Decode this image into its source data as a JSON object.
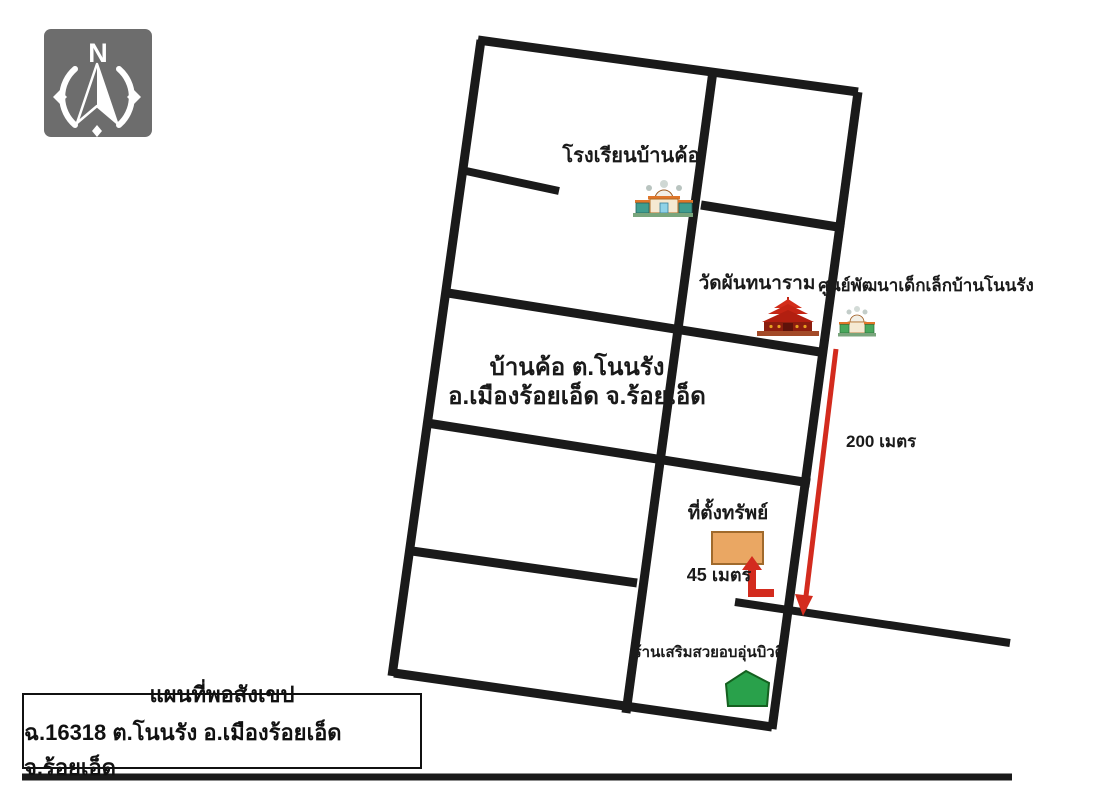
{
  "map": {
    "compass": {
      "north_label": "N"
    },
    "labels": {
      "school": "โรงเรียนบ้านค้อ",
      "temple": "วัดผันทนาราม",
      "childcare": "ศูนย์พัฒนาเด็กเล็กบ้านโนนรัง",
      "village_line1": "บ้านค้อ  ต.โนนรัง",
      "village_line2": "อ.เมืองร้อยเอ็ด  จ.ร้อยเอ็ด",
      "property": "ที่ตั้งทรัพย์",
      "salon": "ร้านเสริมสวยอบอุ่นบิวตี้",
      "distance_200": "200 เมตร",
      "distance_45": "45 เมตร"
    },
    "title_box": {
      "line1": "แผนที่พอสังเขป",
      "line2": "ฉ.16318  ต.โนนรัง  อ.เมืองร้อยเอ็ด  จ.ร้อยเอ็ด"
    },
    "colors": {
      "road_black": "#1a1a1a",
      "arrow_red": "#d32b1e",
      "property_fill": "#eaa763",
      "property_border": "#a06a2c",
      "salon_green": "#29a14b",
      "compass_gray": "#6d6d6d"
    },
    "icons": [
      "compass-rose-icon",
      "school-building-icon",
      "temple-icon",
      "childcare-building-icon",
      "property-marker",
      "salon-house-icon",
      "arrow-200m",
      "arrow-45m"
    ]
  }
}
